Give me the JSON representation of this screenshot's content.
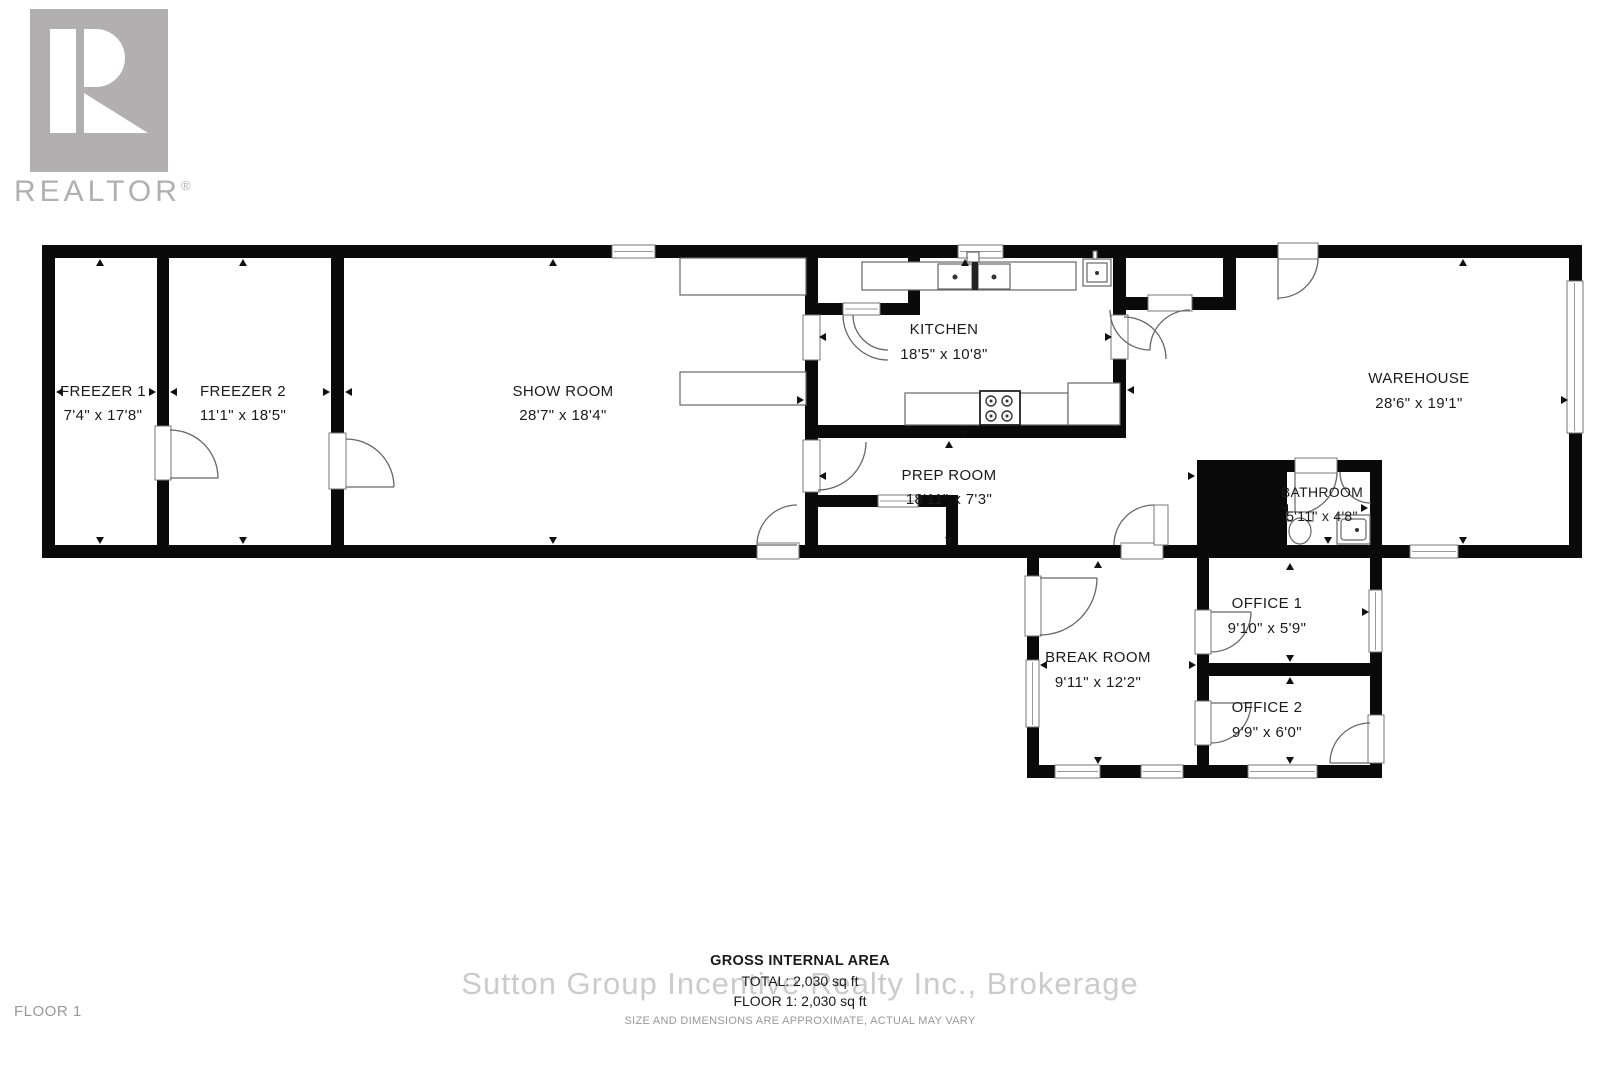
{
  "branding": {
    "logo_text": "REALTOR",
    "registered_mark": "®"
  },
  "watermark": "Sutton Group Incentive Realty Inc., Brokerage",
  "floor_label": "FLOOR 1",
  "footer": {
    "title": "GROSS INTERNAL AREA",
    "total": "TOTAL: 2,030 sq ft",
    "floor_total": "FLOOR 1: 2,030 sq ft",
    "disclaimer": "SIZE AND DIMENSIONS ARE APPROXIMATE, ACTUAL MAY VARY"
  },
  "rooms": [
    {
      "name": "FREEZER 1",
      "dims": "7'4\" x 17'8\""
    },
    {
      "name": "FREEZER 2",
      "dims": "11'1\" x 18'5\""
    },
    {
      "name": "SHOW ROOM",
      "dims": "28'7\" x 18'4\""
    },
    {
      "name": "KITCHEN",
      "dims": "18'5\" x 10'8\""
    },
    {
      "name": "PREP ROOM",
      "dims": "18'11\" x 7'3\""
    },
    {
      "name": "WAREHOUSE",
      "dims": "28'6\" x 19'1\""
    },
    {
      "name": "BATHROOM",
      "dims": "5'11\" x 4'8\""
    },
    {
      "name": "BREAK ROOM",
      "dims": "9'11\" x 12'2\""
    },
    {
      "name": "OFFICE 1",
      "dims": "9'10\" x 5'9\""
    },
    {
      "name": "OFFICE 2",
      "dims": "9'9\" x 6'0\""
    }
  ],
  "colors": {
    "wall": "#0a0a0a",
    "fixture_line": "#666666",
    "logo_gray": "#b1afb0",
    "watermark_gray": "#cbcbcb",
    "muted_text": "#989898",
    "text": "#1a1a1a"
  }
}
